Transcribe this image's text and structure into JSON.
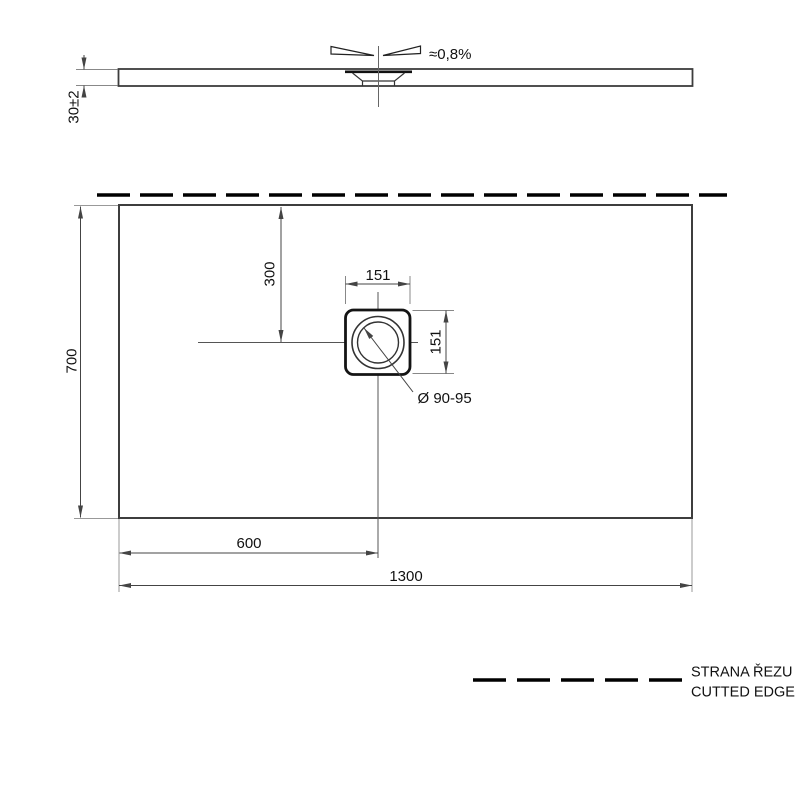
{
  "side_view": {
    "slope_label": "≈0,8%",
    "thickness_label": "30±2"
  },
  "plan_view": {
    "width_label": "1300",
    "height_label": "700",
    "drain_offset_x_label": "600",
    "drain_offset_y_label": "300",
    "drain_width_label": "151",
    "drain_height_label": "151",
    "drain_diameter_label": "Ø 90-95"
  },
  "legend": {
    "label_cz": "STRANA ŘEZU",
    "label_en": "CUTTED EDGE"
  },
  "colors": {
    "outline": "#3d3d3d",
    "cut_edge": "#000000",
    "dimension": "#444444",
    "background": "#ffffff"
  }
}
